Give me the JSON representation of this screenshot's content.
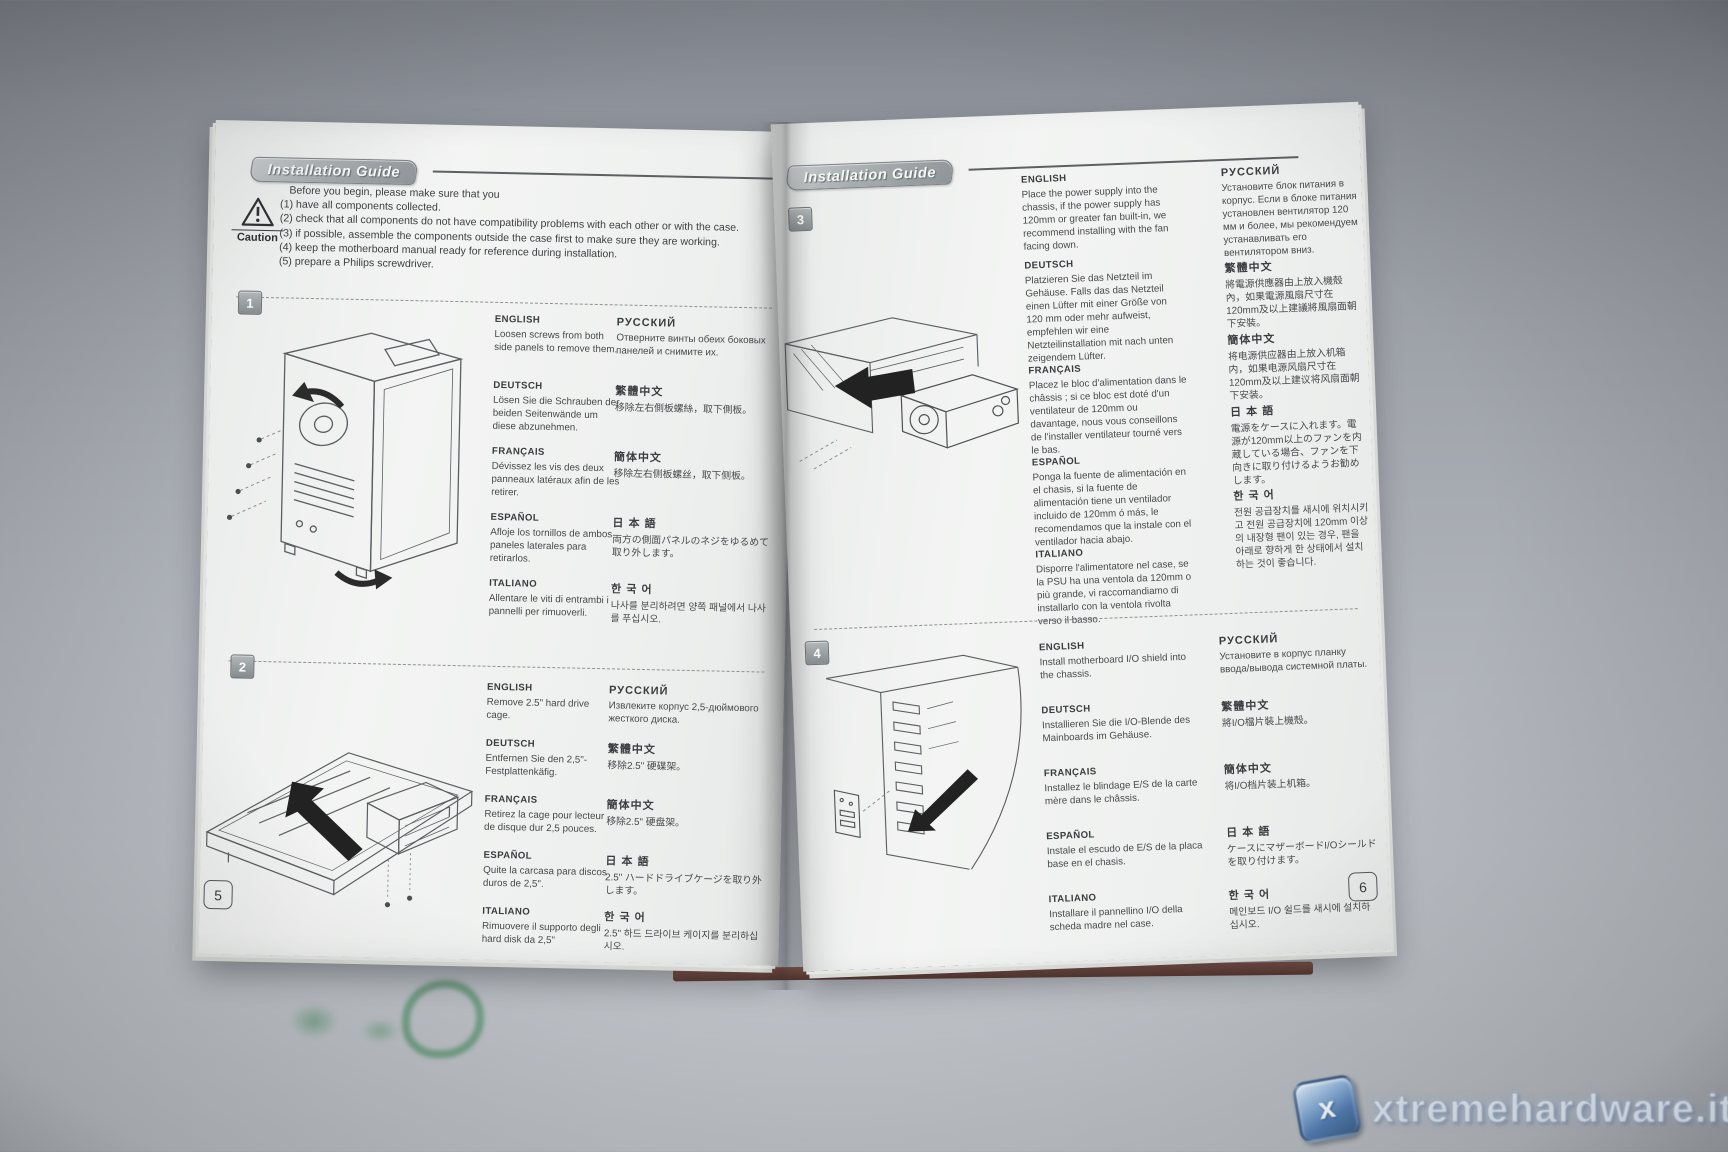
{
  "left_page": {
    "header": "Installation Guide",
    "caution_label": "Caution",
    "page_number": "5",
    "intro": [
      "Before you begin, please make sure that you",
      "(1) have all components collected.",
      "(2) check that all components do not have compatibility problems with each other or with the case.",
      "(3) if possible, assemble the components outside the case first to make sure they are working.",
      "(4) keep the motherboard manual ready for reference during installation.",
      "(5) prepare a Philips screwdriver."
    ],
    "steps": [
      {
        "number": "1",
        "col1": [
          {
            "lang": "ENGLISH",
            "text": "Loosen screws from both side panels to remove them."
          },
          {
            "lang": "DEUTSCH",
            "text": "Lösen Sie die Schrauben der beiden Seitenwände um diese abzunehmen."
          },
          {
            "lang": "FRANÇAIS",
            "text": "Dévissez les vis des deux panneaux latéraux afin de les retirer."
          },
          {
            "lang": "ESPAÑOL",
            "text": "Afloje los tornillos de ambos paneles laterales para retirarlos."
          },
          {
            "lang": "ITALIANO",
            "text": "Allentare le viti di entrambi i pannelli per rimuoverli."
          }
        ],
        "col2": [
          {
            "lang": "РУССКИЙ",
            "text": "Отверните винты обеих боковых панелей и снимите их."
          },
          {
            "lang": "繁體中文",
            "text": "移除左右側板螺絲，取下側板。"
          },
          {
            "lang": "簡体中文",
            "text": "移除左右侧板螺丝，取下侧板。"
          },
          {
            "lang": "日 本 語",
            "text": "両方の側面パネルのネジをゆるめて取り外します。"
          },
          {
            "lang": "한 국 어",
            "text": "나사를 분리하려면 양쪽 패널에서 나사를 푸십시오."
          }
        ]
      },
      {
        "number": "2",
        "col1": [
          {
            "lang": "ENGLISH",
            "text": "Remove 2.5\" hard drive cage."
          },
          {
            "lang": "DEUTSCH",
            "text": "Entfernen Sie den 2,5\"-Festplattenkäfig."
          },
          {
            "lang": "FRANÇAIS",
            "text": "Retirez la cage pour lecteur de disque dur 2,5 pouces."
          },
          {
            "lang": "ESPAÑOL",
            "text": "Quite la carcasa para discos duros de 2,5\"."
          },
          {
            "lang": "ITALIANO",
            "text": "Rimuovere il supporto degli hard disk da 2,5\""
          }
        ],
        "col2": [
          {
            "lang": "РУССКИЙ",
            "text": "Извлеките корпус 2,5-дюймового жесткого диска."
          },
          {
            "lang": "繁體中文",
            "text": "移除2.5\" 硬碟架。"
          },
          {
            "lang": "簡体中文",
            "text": "移除2.5\" 硬盘架。"
          },
          {
            "lang": "日 本 語",
            "text": "2.5\" ハードドライブケージを取り外します。"
          },
          {
            "lang": "한 국 어",
            "text": "2.5\" 하드 드라이브 케이지를 분리하십시오."
          }
        ]
      }
    ]
  },
  "right_page": {
    "header": "Installation Guide",
    "page_number": "6",
    "steps": [
      {
        "number": "3",
        "col1": [
          {
            "lang": "ENGLISH",
            "text": "Place the power supply into the chassis, if the power supply has 120mm or greater fan built-in, we recommend installing with the fan facing down."
          },
          {
            "lang": "DEUTSCH",
            "text": "Platzieren Sie das Netzteil im Gehäuse. Falls das das Netzteil einen Lüfter mit einer Größe von 120 mm oder mehr aufweist, empfehlen wir eine Netzteilinstallation mit nach unten zeigendem Lüfter."
          },
          {
            "lang": "FRANÇAIS",
            "text": "Placez le bloc d'alimentation dans le châssis ; si ce bloc est doté d'un ventilateur de 120mm ou davantage, nous vous conseillons de l'installer ventilateur tourné vers le bas."
          },
          {
            "lang": "ESPAÑOL",
            "text": "Ponga la fuente de alimentación en el chasis, si la fuente de alimentación tiene un ventilador incluido de 120mm ó más, le recomendamos que la instale con el ventilador hacia abajo."
          },
          {
            "lang": "ITALIANO",
            "text": "Disporre l'alimentatore nel case, se la PSU ha una ventola da 120mm o più grande, vi raccomandiamo di installarlo con la ventola rivolta verso il basso."
          }
        ],
        "col2": [
          {
            "lang": "РУССКИЙ",
            "text": "Установите блок питания в корпус. Если в блоке питания установлен вентилятор 120 мм и более, мы рекомендуем устанавливать его вентилятором вниз."
          },
          {
            "lang": "繁體中文",
            "text": "將電源供應器由上放入機殼內，如果電源風扇尺寸在120mm及以上建議將風扇面朝下安裝。"
          },
          {
            "lang": "簡体中文",
            "text": "将电源供应器由上放入机箱内，如果电源风扇尺寸在120mm及以上建议将风扇面朝下安装。"
          },
          {
            "lang": "日 本 語",
            "text": "電源をケースに入れます。電源が120mm以上のファンを内蔵している場合、ファンを下向きに取り付けるようお勧めします。"
          },
          {
            "lang": "한 국 어",
            "text": "전원 공급장치를 새시에 위치시키고 전원 공급장치에 120mm 이상의 내장형 팬이 있는 경우, 팬을 아래로 향하게 한 상태에서 설치하는 것이 좋습니다."
          }
        ]
      },
      {
        "number": "4",
        "col1": [
          {
            "lang": "ENGLISH",
            "text": "Install motherboard I/O shield into the chassis."
          },
          {
            "lang": "DEUTSCH",
            "text": "Installieren Sie die I/O-Blende des Mainboards im Gehäuse."
          },
          {
            "lang": "FRANÇAIS",
            "text": "Installez le blindage E/S de la carte mère dans le châssis."
          },
          {
            "lang": "ESPAÑOL",
            "text": "Instale el escudo de E/S de la placa base en el chasis."
          },
          {
            "lang": "ITALIANO",
            "text": "Installare il pannellino I/O della scheda madre nel case."
          }
        ],
        "col2": [
          {
            "lang": "РУССКИЙ",
            "text": "Установите в корпус планку ввода/вывода системной платы."
          },
          {
            "lang": "繁體中文",
            "text": "將I/O檔片裝上機殼。"
          },
          {
            "lang": "簡体中文",
            "text": "将I/O档片装上机箱。"
          },
          {
            "lang": "日 本 語",
            "text": "ケースにマザーボードI/Oシールドを取り付けます。"
          },
          {
            "lang": "한 국 어",
            "text": "메인보드 I/O 쉴드를 새시에 설치하십시오."
          }
        ]
      }
    ]
  },
  "watermark": {
    "text": "xtremehardware.it",
    "logo_letter": "x"
  }
}
